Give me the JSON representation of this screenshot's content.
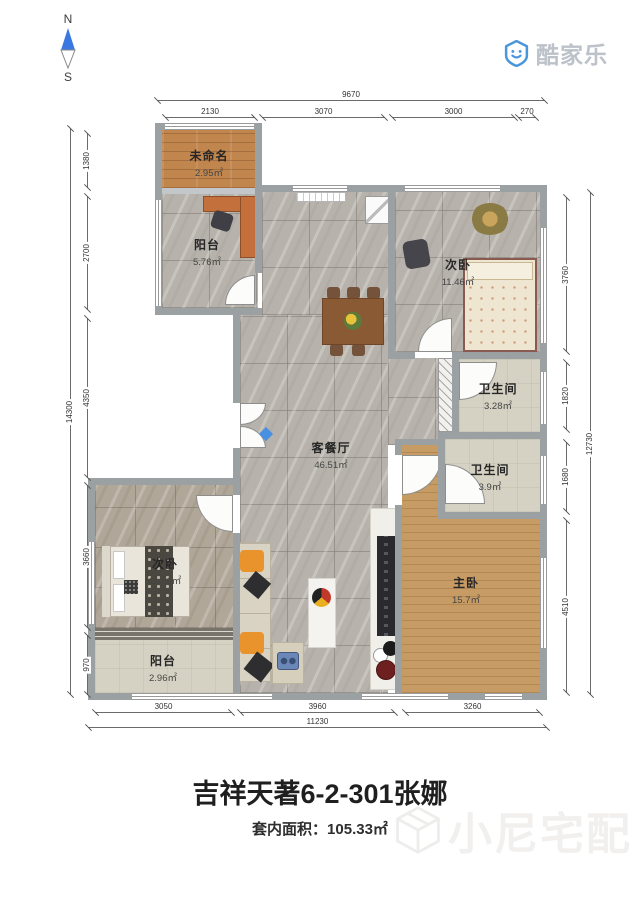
{
  "compass": {
    "north": "N",
    "south": "S"
  },
  "logo": {
    "brand": "酷家乐"
  },
  "watermark": {
    "text": "小尼宅配"
  },
  "rooms": [
    {
      "id": "unnamed",
      "name": "未命名",
      "area": "2.95㎡"
    },
    {
      "id": "balcony-top",
      "name": "阳台",
      "area": "5.76㎡"
    },
    {
      "id": "bedroom-right",
      "name": "次卧",
      "area": "11.46㎡"
    },
    {
      "id": "bathroom-1",
      "name": "卫生间",
      "area": "3.28㎡"
    },
    {
      "id": "bathroom-2",
      "name": "卫生间",
      "area": "3.9㎡"
    },
    {
      "id": "living-dining",
      "name": "客餐厅",
      "area": "46.51㎡"
    },
    {
      "id": "bedroom-left",
      "name": "次卧",
      "area": "11.16㎡"
    },
    {
      "id": "master-bedroom",
      "name": "主卧",
      "area": "15.7㎡"
    },
    {
      "id": "balcony-bottom",
      "name": "阳台",
      "area": "2.96㎡"
    }
  ],
  "dimensions": {
    "top": {
      "total": "9670",
      "segments": [
        "2130",
        "3070",
        "3000",
        "270"
      ]
    },
    "left": {
      "total": "14300",
      "segments": [
        "1380",
        "2700",
        "4350",
        "3660",
        "970"
      ]
    },
    "right": {
      "total": "12730",
      "segments": [
        "3760",
        "1820",
        "1680",
        "4510"
      ]
    },
    "bottom": {
      "total": "11230",
      "segments": [
        "3050",
        "3960",
        "3260"
      ]
    }
  },
  "footer": {
    "title": "吉祥天著6-2-301张娜",
    "area_line": "套内面积：105.33㎡"
  },
  "colors": {
    "compass_blue": "#3b77e0",
    "logo_blue": "#4a96dd",
    "wall_gray": "#9ba0a3",
    "wood": "#c79b64",
    "tile": "#b7b3ac"
  }
}
